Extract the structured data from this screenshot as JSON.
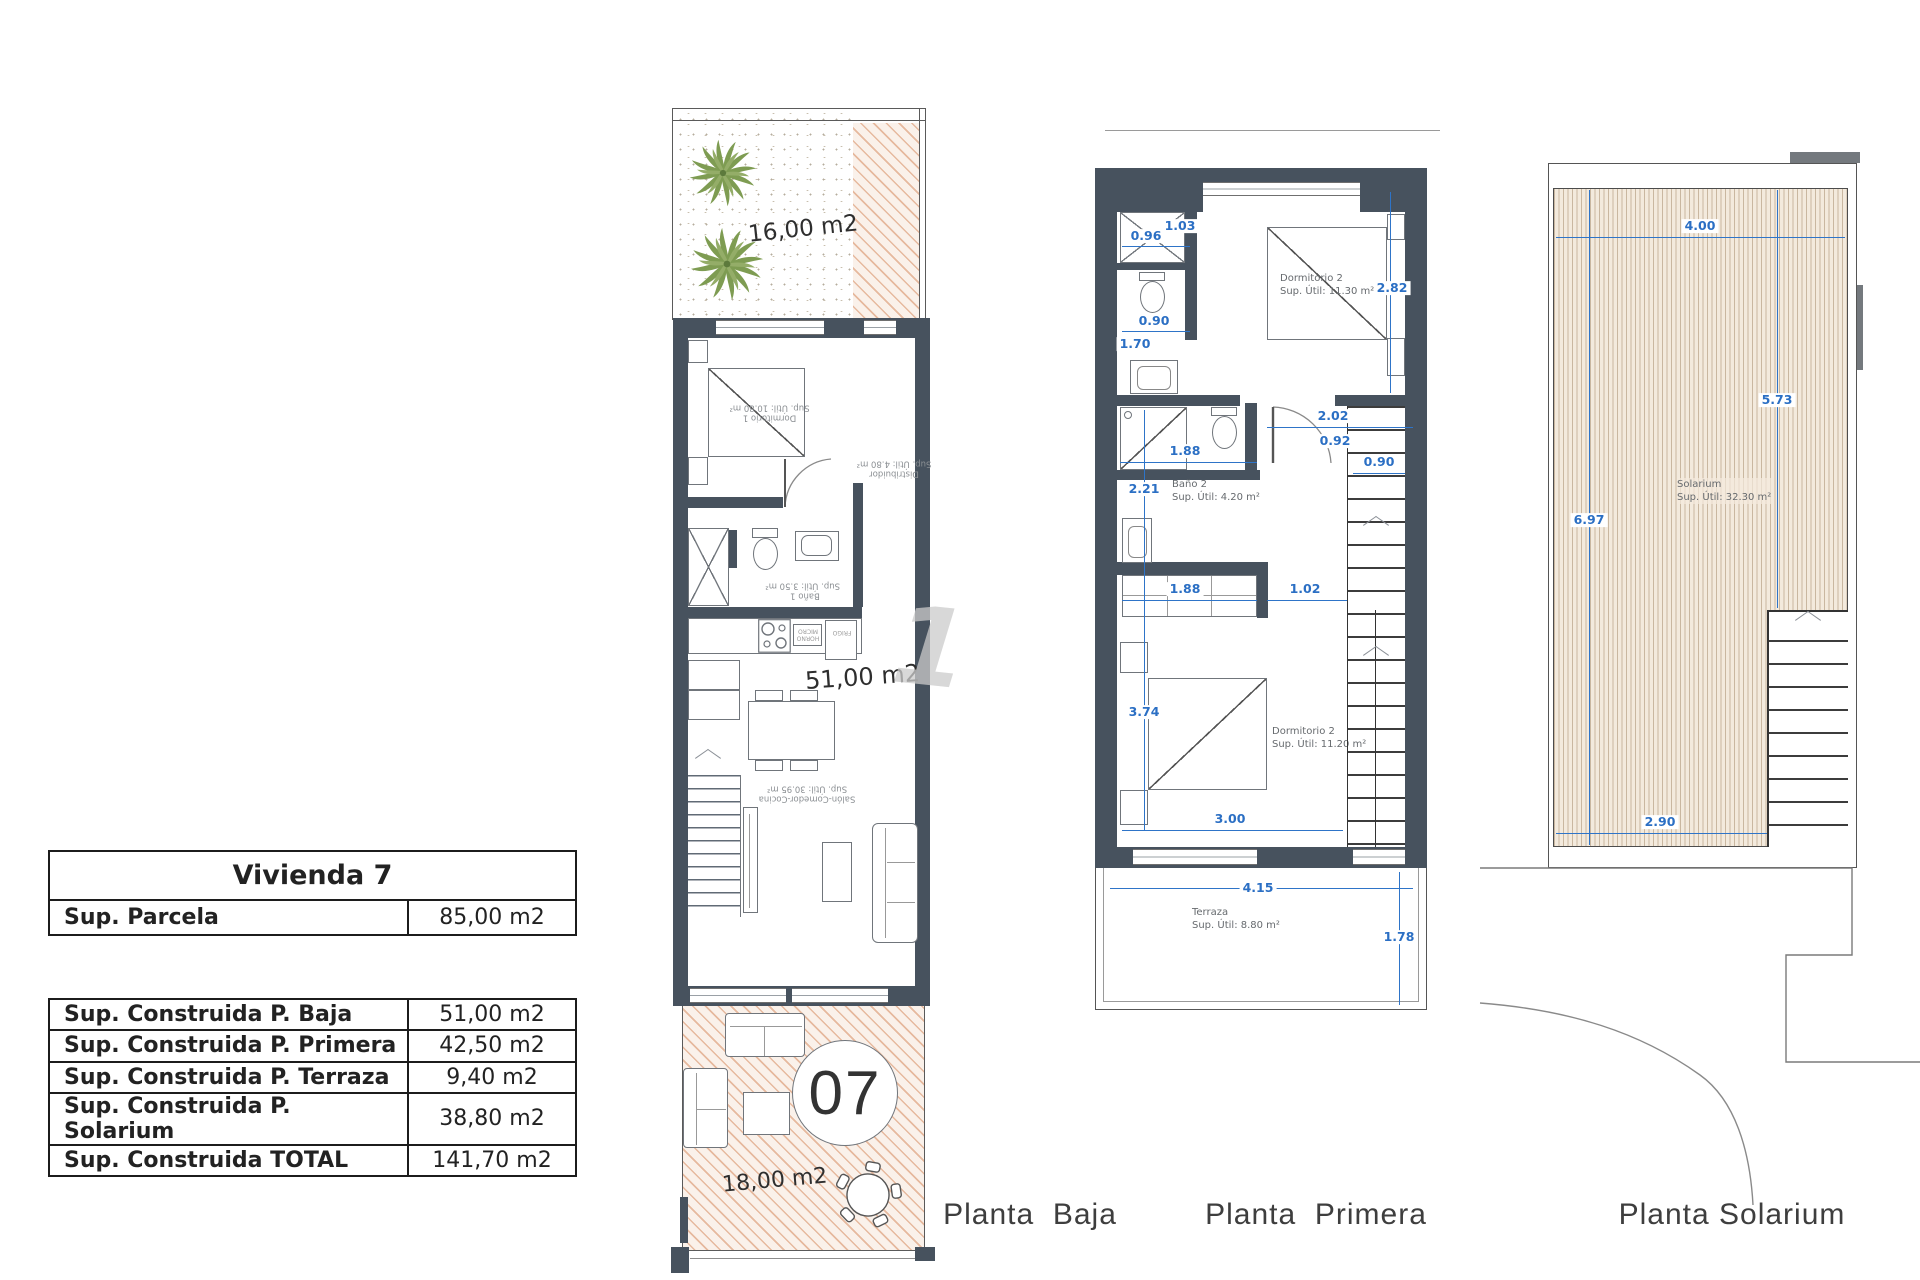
{
  "watermark": "1",
  "summary": {
    "title": "Vivienda 7",
    "parcela": {
      "label": "Sup. Parcela",
      "value": "85,00 m2"
    },
    "rows": [
      {
        "label": "Sup. Construida P. Baja",
        "value": "51,00 m2"
      },
      {
        "label": "Sup. Construida P. Primera",
        "value": "42,50 m2"
      },
      {
        "label": "Sup. Construida P. Terraza",
        "value": "9,40 m2"
      },
      {
        "label": "Sup. Construida P. Solarium",
        "value": "38,80 m2"
      },
      {
        "label": "Sup. Construida TOTAL",
        "value": "141,70 m2"
      }
    ]
  },
  "baja": {
    "caption": "Planta  Baja",
    "garden_area": "16,00 m2",
    "living_area": "51,00 m2",
    "terrace_area": "18,00 m2",
    "unit": "07",
    "rooms": {
      "dormitorio1": {
        "name": "Dormitorio 1",
        "sup": "Sup. Útil: 10.80 m²"
      },
      "distribuidor": {
        "name": "Distribuidor",
        "sup": "Sup. Útil: 4.80 m²"
      },
      "bano1": {
        "name": "Baño 1",
        "sup": "Sup. Útil: 3.50 m²"
      },
      "salon": {
        "name": "Salón-Comedor-Cocina",
        "sup": "Sup. Útil: 30.95 m²"
      }
    },
    "appliances": {
      "horno": "HORNO MICRO",
      "frigo": "FRIGO"
    }
  },
  "primera": {
    "caption": "Planta  Primera",
    "rooms": {
      "dorm2": {
        "name": "Dormitorio 2",
        "sup": "Sup. Útil: 11.30 m²"
      },
      "bano2": {
        "name": "Baño 2",
        "sup": "Sup. Útil: 4.20 m²"
      },
      "dorm3": {
        "name": "Dormitorio 2",
        "sup": "Sup. Útil: 11.20 m²"
      },
      "terraza": {
        "name": "Terraza",
        "sup": "Sup. Útil: 8.80 m²"
      }
    },
    "dims": {
      "d096": "0.96",
      "d103": "1.03",
      "d090a": "0.90",
      "d170": "1.70",
      "d282": "2.82",
      "d202": "2.02",
      "d092": "0.92",
      "d090b": "0.90",
      "d188a": "1.88",
      "d221": "2.21",
      "d188b": "1.88",
      "d102": "1.02",
      "d374": "3.74",
      "d300": "3.00",
      "d415": "4.15",
      "d178": "1.78"
    }
  },
  "solarium": {
    "caption": "Planta Solarium",
    "room": {
      "name": "Solarium",
      "sup": "Sup. Útil: 32.30 m²"
    },
    "dims": {
      "d400": "4.00",
      "d573": "5.73",
      "d697": "6.97",
      "d290": "2.90"
    }
  }
}
